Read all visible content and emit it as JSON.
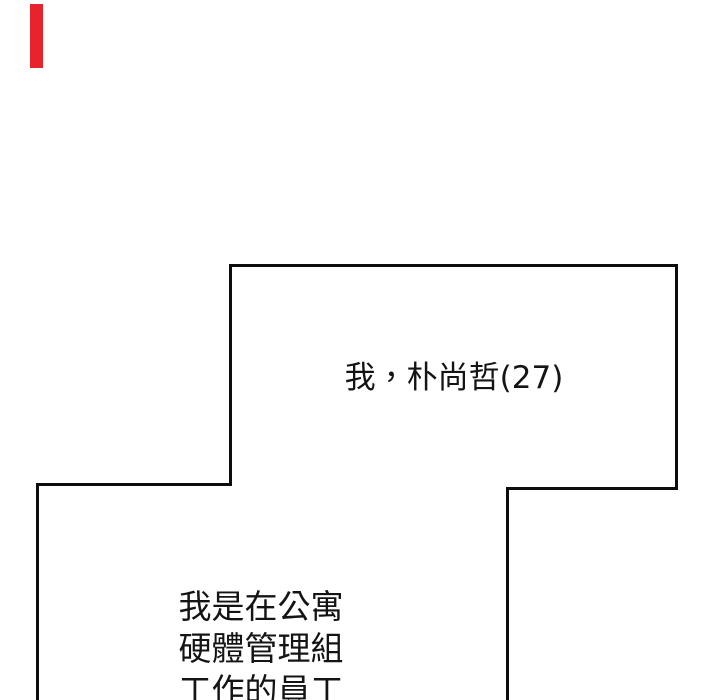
{
  "page": {
    "background_color": "#ffffff",
    "panel_line_color": "#0d0d0d",
    "text_color": "#141414",
    "red_mark_color": "#e7242b"
  },
  "panels": {
    "top_caption": "我，朴尚哲(27)",
    "bottom_caption_lines": [
      "我是在公寓",
      "硬體管理組",
      "工作的員工"
    ]
  }
}
